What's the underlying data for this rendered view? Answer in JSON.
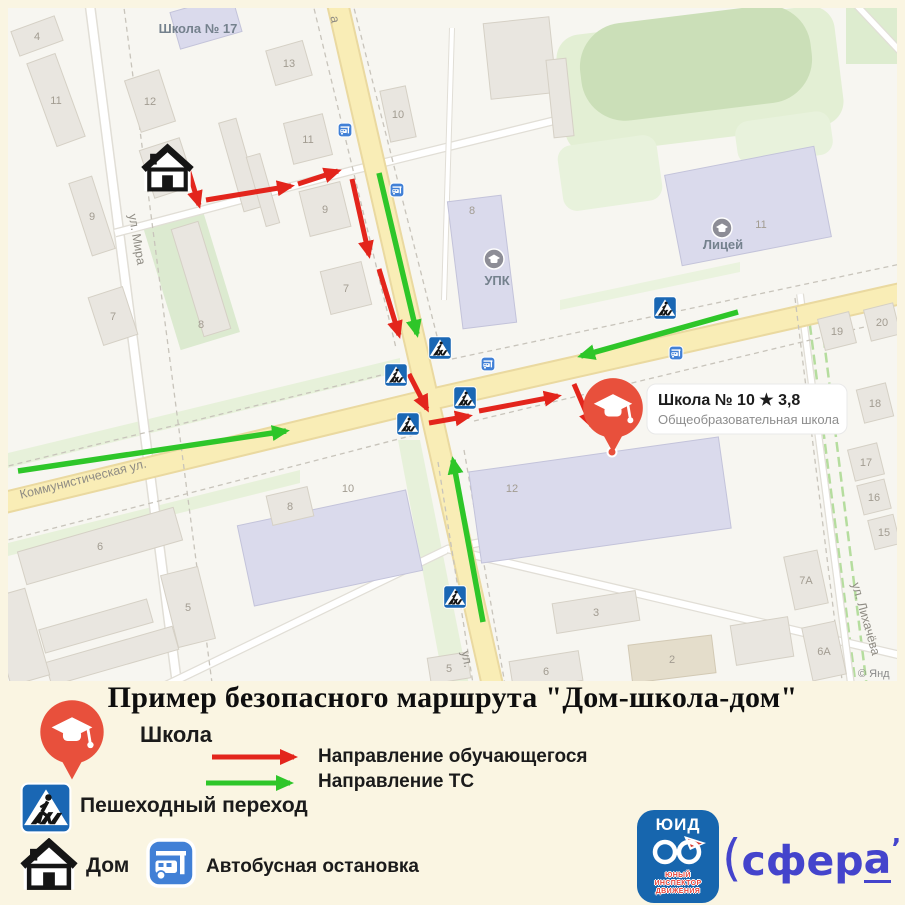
{
  "title": "Пример безопасного маршрута \"Дом-школа-дом\"",
  "colors": {
    "student_route": "#e3251c",
    "vehicle_route": "#2ec629",
    "sign_blue": "#1a67b4",
    "pin_red": "#e8503c"
  },
  "map": {
    "copyright": "© Янд",
    "street_labels": [
      {
        "text": "ул. Мира",
        "x": 133,
        "y": 240,
        "rot": 80
      },
      {
        "text": "Коммунистическая ул.",
        "x": 84,
        "y": 483,
        "rot": -14
      },
      {
        "text": "ул. Лихачёва",
        "x": 862,
        "y": 620,
        "rot": 74
      },
      {
        "text": "ул.",
        "x": 463,
        "y": 660,
        "rot": 78
      },
      {
        "text": "а",
        "x": 331,
        "y": 20,
        "rot": 80
      }
    ],
    "poi_labels": [
      {
        "text": "Школа № 17",
        "x": 198,
        "y": 33,
        "icon": null
      },
      {
        "text": "УПК",
        "x": 497,
        "y": 285,
        "icon": [
          494,
          259
        ]
      },
      {
        "text": "Лицей",
        "x": 723,
        "y": 249,
        "icon": [
          722,
          228
        ]
      }
    ],
    "buildings": [
      {
        "cx": 37,
        "cy": 36,
        "w": 46,
        "h": 26,
        "r": -20,
        "label": "4"
      },
      {
        "cx": 56,
        "cy": 100,
        "w": 30,
        "h": 88,
        "r": -20,
        "label": "11"
      },
      {
        "cx": 150,
        "cy": 101,
        "w": 36,
        "h": 54,
        "r": -18,
        "label": "12"
      },
      {
        "cx": 206,
        "cy": 22,
        "w": 64,
        "h": 38,
        "r": -16,
        "fill": "p"
      },
      {
        "cx": 289,
        "cy": 63,
        "w": 38,
        "h": 36,
        "r": -16,
        "label": "13"
      },
      {
        "cx": 167,
        "cy": 168,
        "w": 42,
        "h": 50,
        "r": -18
      },
      {
        "cx": 92,
        "cy": 216,
        "w": 24,
        "h": 76,
        "r": -18,
        "label": "9"
      },
      {
        "cx": 201,
        "cy": 279,
        "w": 28,
        "h": 112,
        "r": -17,
        "label": "8",
        "ldy": 45
      },
      {
        "cx": 113,
        "cy": 316,
        "w": 36,
        "h": 50,
        "r": -18,
        "label": "7"
      },
      {
        "cx": 240,
        "cy": 165,
        "w": 18,
        "h": 92,
        "r": -16
      },
      {
        "cx": 263,
        "cy": 190,
        "w": 14,
        "h": 72,
        "r": -16
      },
      {
        "cx": 398,
        "cy": 114,
        "w": 26,
        "h": 52,
        "r": -12,
        "label": "10"
      },
      {
        "cx": 308,
        "cy": 139,
        "w": 40,
        "h": 42,
        "r": -14,
        "label": "11"
      },
      {
        "cx": 325,
        "cy": 209,
        "w": 42,
        "h": 46,
        "r": -14,
        "label": "9"
      },
      {
        "cx": 346,
        "cy": 288,
        "w": 42,
        "h": 44,
        "r": -14,
        "label": "7"
      },
      {
        "cx": 520,
        "cy": 58,
        "w": 66,
        "h": 76,
        "r": -6
      },
      {
        "cx": 560,
        "cy": 98,
        "w": 20,
        "h": 78,
        "r": -6
      },
      {
        "cx": 482,
        "cy": 262,
        "w": 54,
        "h": 128,
        "r": -7,
        "fill": "p",
        "label": "8",
        "ldx": -10,
        "ldy": -52
      },
      {
        "cx": 748,
        "cy": 206,
        "w": 152,
        "h": 92,
        "r": -11,
        "fill": "p",
        "label": "11",
        "ldx": 13,
        "ldy": 18
      },
      {
        "cx": 837,
        "cy": 331,
        "w": 32,
        "h": 32,
        "r": -14,
        "label": "19"
      },
      {
        "cx": 882,
        "cy": 322,
        "w": 30,
        "h": 32,
        "r": -14,
        "label": "20"
      },
      {
        "cx": 875,
        "cy": 403,
        "w": 30,
        "h": 34,
        "r": -14,
        "label": "18"
      },
      {
        "cx": 866,
        "cy": 462,
        "w": 30,
        "h": 32,
        "r": -14,
        "label": "17"
      },
      {
        "cx": 874,
        "cy": 497,
        "w": 28,
        "h": 30,
        "r": -14,
        "label": "16"
      },
      {
        "cx": 884,
        "cy": 532,
        "w": 26,
        "h": 30,
        "r": -14,
        "label": "15"
      },
      {
        "cx": 806,
        "cy": 580,
        "w": 34,
        "h": 54,
        "r": -12,
        "label": "7A"
      },
      {
        "cx": 824,
        "cy": 651,
        "w": 34,
        "h": 54,
        "r": -12,
        "label": "6A"
      },
      {
        "cx": 330,
        "cy": 548,
        "w": 172,
        "h": 82,
        "r": -12,
        "fill": "p",
        "label": "10",
        "ldx": 18,
        "ldy": -60
      },
      {
        "cx": 600,
        "cy": 500,
        "w": 252,
        "h": 92,
        "r": -8,
        "fill": "p",
        "label": "12",
        "ldx": -88,
        "ldy": -12
      },
      {
        "cx": 100,
        "cy": 546,
        "w": 162,
        "h": 34,
        "r": -16,
        "label": "6"
      },
      {
        "cx": 188,
        "cy": 607,
        "w": 38,
        "h": 74,
        "r": -14,
        "label": "5"
      },
      {
        "cx": 96,
        "cy": 626,
        "w": 112,
        "h": 24,
        "r": -16
      },
      {
        "cx": 112,
        "cy": 656,
        "w": 132,
        "h": 24,
        "r": -16
      },
      {
        "cx": 290,
        "cy": 506,
        "w": 42,
        "h": 30,
        "r": -13,
        "label": "8"
      },
      {
        "cx": 596,
        "cy": 612,
        "w": 84,
        "h": 30,
        "r": -9,
        "label": "3"
      },
      {
        "cx": 672,
        "cy": 659,
        "w": 84,
        "h": 38,
        "r": -7,
        "fill": "t",
        "label": "2"
      },
      {
        "cx": 546,
        "cy": 671,
        "w": 70,
        "h": 30,
        "r": -9,
        "label": "6"
      },
      {
        "cx": 449,
        "cy": 668,
        "w": 40,
        "h": 26,
        "r": -9,
        "label": "5"
      },
      {
        "cx": 762,
        "cy": 641,
        "w": 58,
        "h": 40,
        "r": -9
      },
      {
        "cx": 18,
        "cy": 637,
        "w": 40,
        "h": 90,
        "r": -16
      }
    ],
    "red_arrows": [
      [
        [
          188,
          169
        ],
        [
          199,
          205
        ]
      ],
      [
        [
          206,
          200
        ],
        [
          291,
          186
        ]
      ],
      [
        [
          298,
          184
        ],
        [
          338,
          171
        ]
      ],
      [
        [
          352,
          179
        ],
        [
          369,
          255
        ]
      ],
      [
        [
          379,
          269
        ],
        [
          399,
          335
        ]
      ],
      [
        [
          409,
          374
        ],
        [
          427,
          409
        ]
      ],
      [
        [
          429,
          423
        ],
        [
          469,
          416
        ]
      ],
      [
        [
          479,
          411
        ],
        [
          558,
          396
        ]
      ],
      [
        [
          574,
          384
        ],
        [
          592,
          426
        ]
      ]
    ],
    "green_arrows": [
      [
        [
          379,
          173
        ],
        [
          417,
          334
        ]
      ],
      [
        [
          483,
          622
        ],
        [
          453,
          460
        ]
      ],
      [
        [
          738,
          312
        ],
        [
          581,
          356
        ]
      ],
      [
        [
          18,
          471
        ],
        [
          286,
          431
        ]
      ]
    ],
    "ped_signs": [
      [
        440,
        348
      ],
      [
        396,
        375
      ],
      [
        465,
        398
      ],
      [
        408,
        424
      ],
      [
        665,
        308
      ],
      [
        455,
        597
      ]
    ],
    "bus_stops": [
      [
        345,
        130
      ],
      [
        397,
        190
      ],
      [
        488,
        364
      ],
      [
        676,
        353
      ]
    ],
    "house": {
      "x": 141,
      "y": 143,
      "size": 53
    },
    "callout": {
      "pin": [
        613,
        410
      ],
      "dot": [
        612,
        452
      ],
      "box": [
        647,
        384,
        200,
        50
      ],
      "title": "Школа № 10",
      "star": "★",
      "rating": "3,8",
      "subtitle": "Общеобразовательная школа"
    }
  },
  "legend": {
    "school_label": "Школа",
    "student_dir_label": "Направление обучающегося",
    "vehicle_dir_label": "Направление ТС",
    "ped_label": "Пешеходный переход",
    "home_label": "Дом",
    "bus_label": "Автобусная остановка",
    "uid_logo": {
      "title": "ЮИД",
      "lines": [
        "ЮНЫЙ",
        "ИНСПЕКТОР",
        "ДВИЖЕНИЯ"
      ]
    },
    "sfera_logo": {
      "open": "(",
      "head": "сфер",
      "tail": "а",
      "tick": "’",
      "close": ")"
    }
  }
}
